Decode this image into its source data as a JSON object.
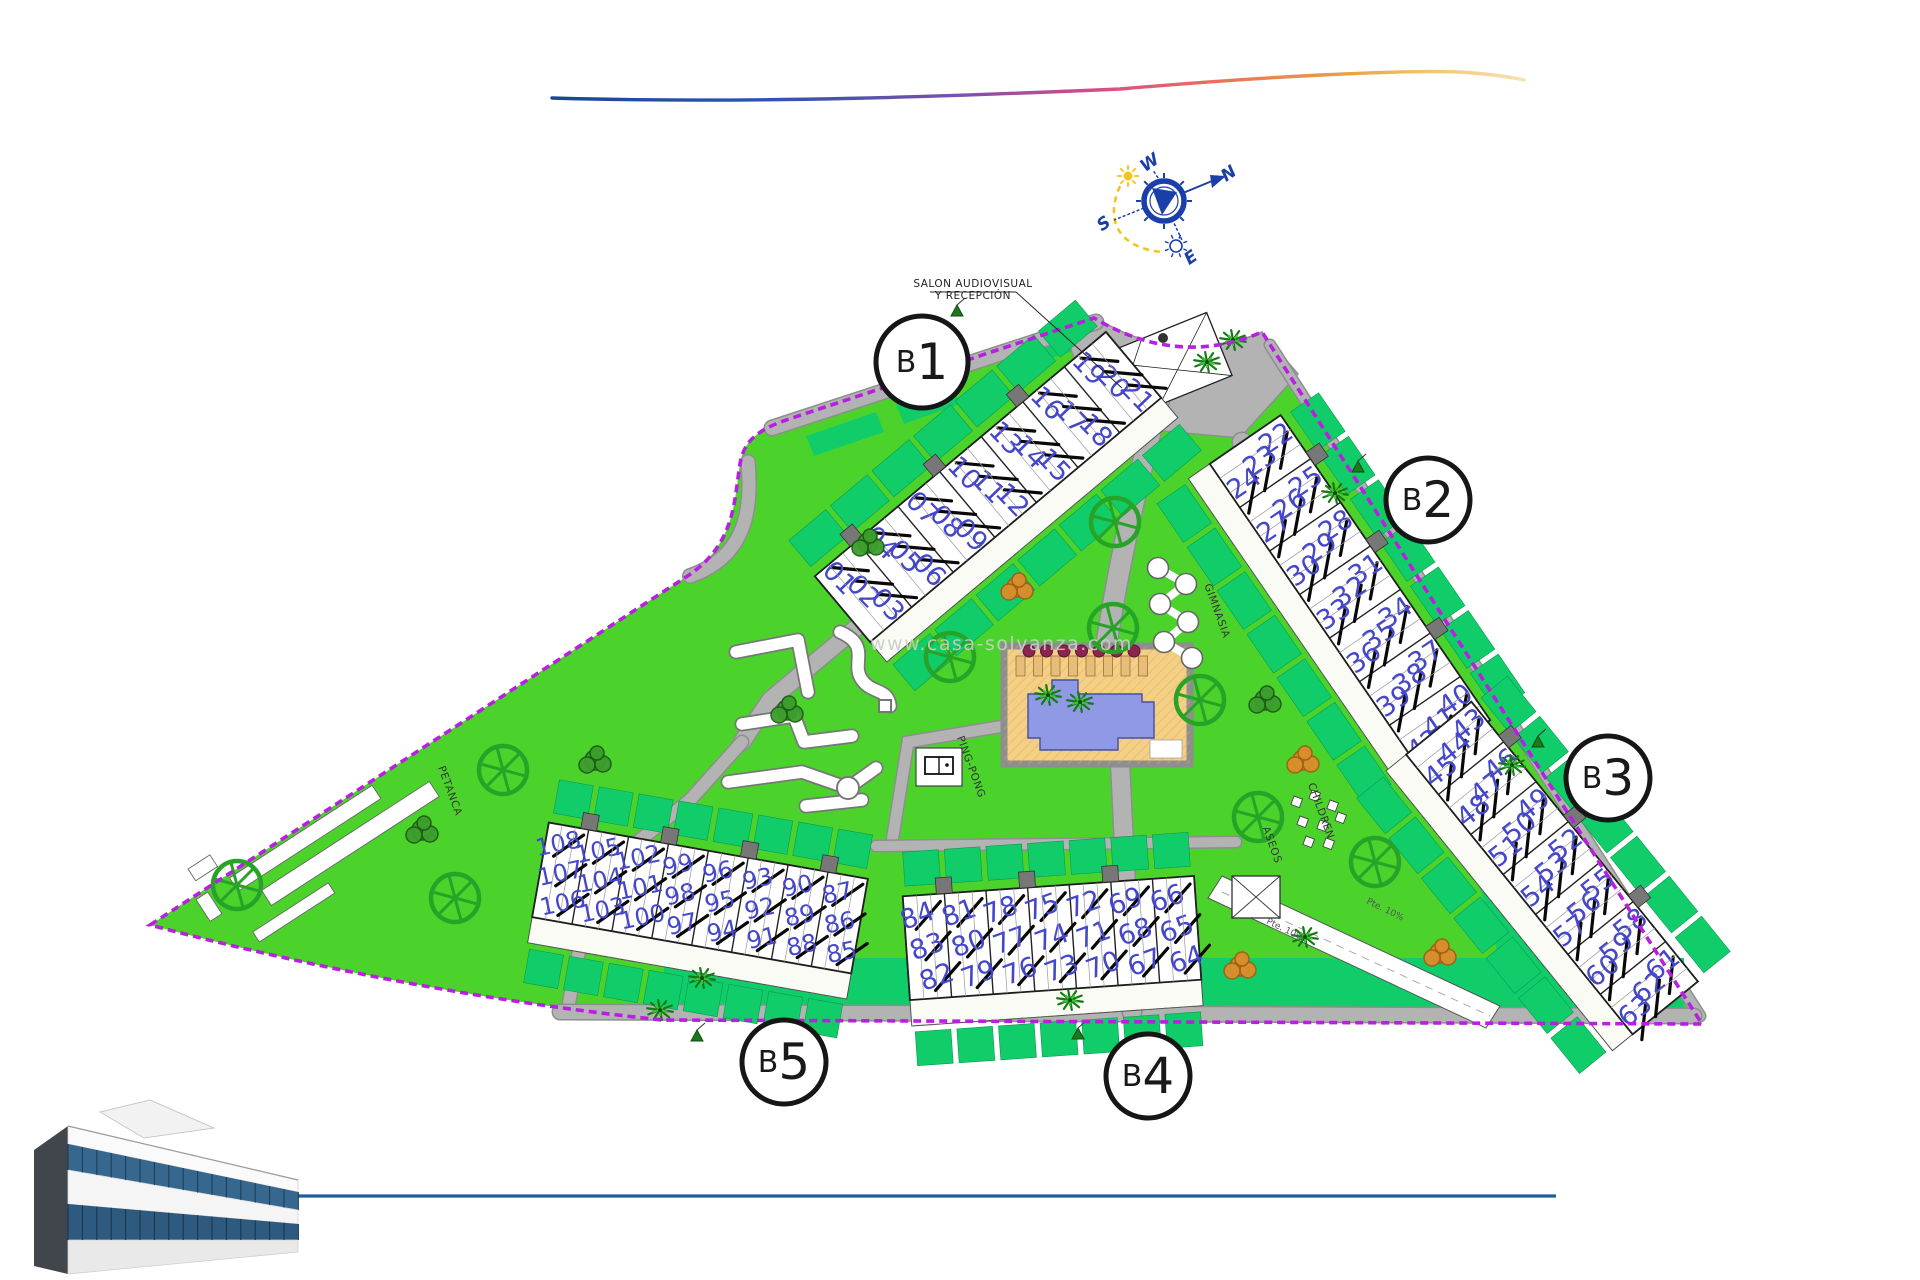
{
  "branding": {
    "watermark": "www.casa-solyanza.com",
    "swoosh_colors": [
      "#1c4690",
      "#2c55b0",
      "#7e4fae",
      "#d14b8a",
      "#e8705e",
      "#efa03c",
      "#ecc14e"
    ],
    "bottom_line_color": "#1d5e9e"
  },
  "compass": {
    "points": [
      {
        "label": "W",
        "x": 1150,
        "y": 163
      },
      {
        "label": "N",
        "x": 1229,
        "y": 174
      },
      {
        "label": "S",
        "x": 1104,
        "y": 224
      },
      {
        "label": "E",
        "x": 1191,
        "y": 258
      }
    ],
    "accent_blue": "#1b3fa8",
    "sun_yellow": "#f2c21d"
  },
  "site": {
    "boundary_color": "#b81fe0",
    "lawn_color": "#4bd32c",
    "garden_color": "#10cd6a",
    "road_color": "#b3b3b3",
    "unit_number_color": "#4547cb",
    "pool": {
      "deck_color": "#f4cf86",
      "water_color": "#8f99e6"
    },
    "buildings": [
      {
        "id": "b1",
        "label": "B1",
        "bays": [
          [
            "01",
            "02",
            "03"
          ],
          [
            "04",
            "05",
            "06"
          ],
          [
            "07",
            "08",
            "09"
          ],
          [
            "10",
            "11",
            "12"
          ],
          [
            "13",
            "14",
            "15"
          ],
          [
            "16",
            "17",
            "18"
          ],
          [
            "19",
            "20",
            "21"
          ]
        ]
      },
      {
        "id": "b2",
        "label": "B2",
        "bays": [
          [
            "22",
            "23",
            "24"
          ],
          [
            "25",
            "26",
            "27"
          ],
          [
            "28",
            "29",
            "30"
          ],
          [
            "31",
            "32",
            "33"
          ],
          [
            "34",
            "35",
            "36"
          ],
          [
            "37",
            "38",
            "39"
          ],
          [
            "40",
            "41",
            "42"
          ]
        ]
      },
      {
        "id": "b3",
        "label": "B3",
        "bays": [
          [
            "43",
            "44",
            "45"
          ],
          [
            "46",
            "47",
            "48"
          ],
          [
            "49",
            "50",
            "51"
          ],
          [
            "52",
            "53",
            "54"
          ],
          [
            "55",
            "56",
            "57"
          ],
          [
            "58",
            "59",
            "60"
          ],
          [
            "61",
            "62",
            "63"
          ]
        ]
      },
      {
        "id": "b4",
        "label": "B4",
        "bays": [
          [
            "84",
            "83",
            "82"
          ],
          [
            "81",
            "80",
            "79"
          ],
          [
            "78",
            "77",
            "76"
          ],
          [
            "75",
            "74",
            "73"
          ],
          [
            "72",
            "71",
            "70"
          ],
          [
            "69",
            "68",
            "67"
          ],
          [
            "66",
            "65",
            "64"
          ]
        ]
      },
      {
        "id": "b5",
        "label": "B5",
        "bays": [
          [
            "108",
            "107",
            "106"
          ],
          [
            "105",
            "104",
            "103"
          ],
          [
            "102",
            "101",
            "100"
          ],
          [
            "99",
            "98",
            "97"
          ],
          [
            "96",
            "95",
            "94"
          ],
          [
            "93",
            "92",
            "91"
          ],
          [
            "90",
            "89",
            "88"
          ],
          [
            "87",
            "86",
            "85"
          ]
        ]
      }
    ],
    "facility_labels": [
      {
        "id": "salon",
        "lines": [
          "SALON AUDIOVISUAL",
          "Y RECEPCIÓN"
        ]
      },
      {
        "id": "petanca",
        "text": "PETANCA"
      },
      {
        "id": "pingpong",
        "text": "PING-PONG"
      },
      {
        "id": "gimnasia",
        "text": "GIMNASIA"
      },
      {
        "id": "children",
        "text": "CHILDREN"
      },
      {
        "id": "aseos",
        "text": "ASEOS"
      }
    ],
    "road_labels": [
      {
        "text": "Pte. 10%"
      },
      {
        "text": "Pte. 10%"
      }
    ]
  }
}
